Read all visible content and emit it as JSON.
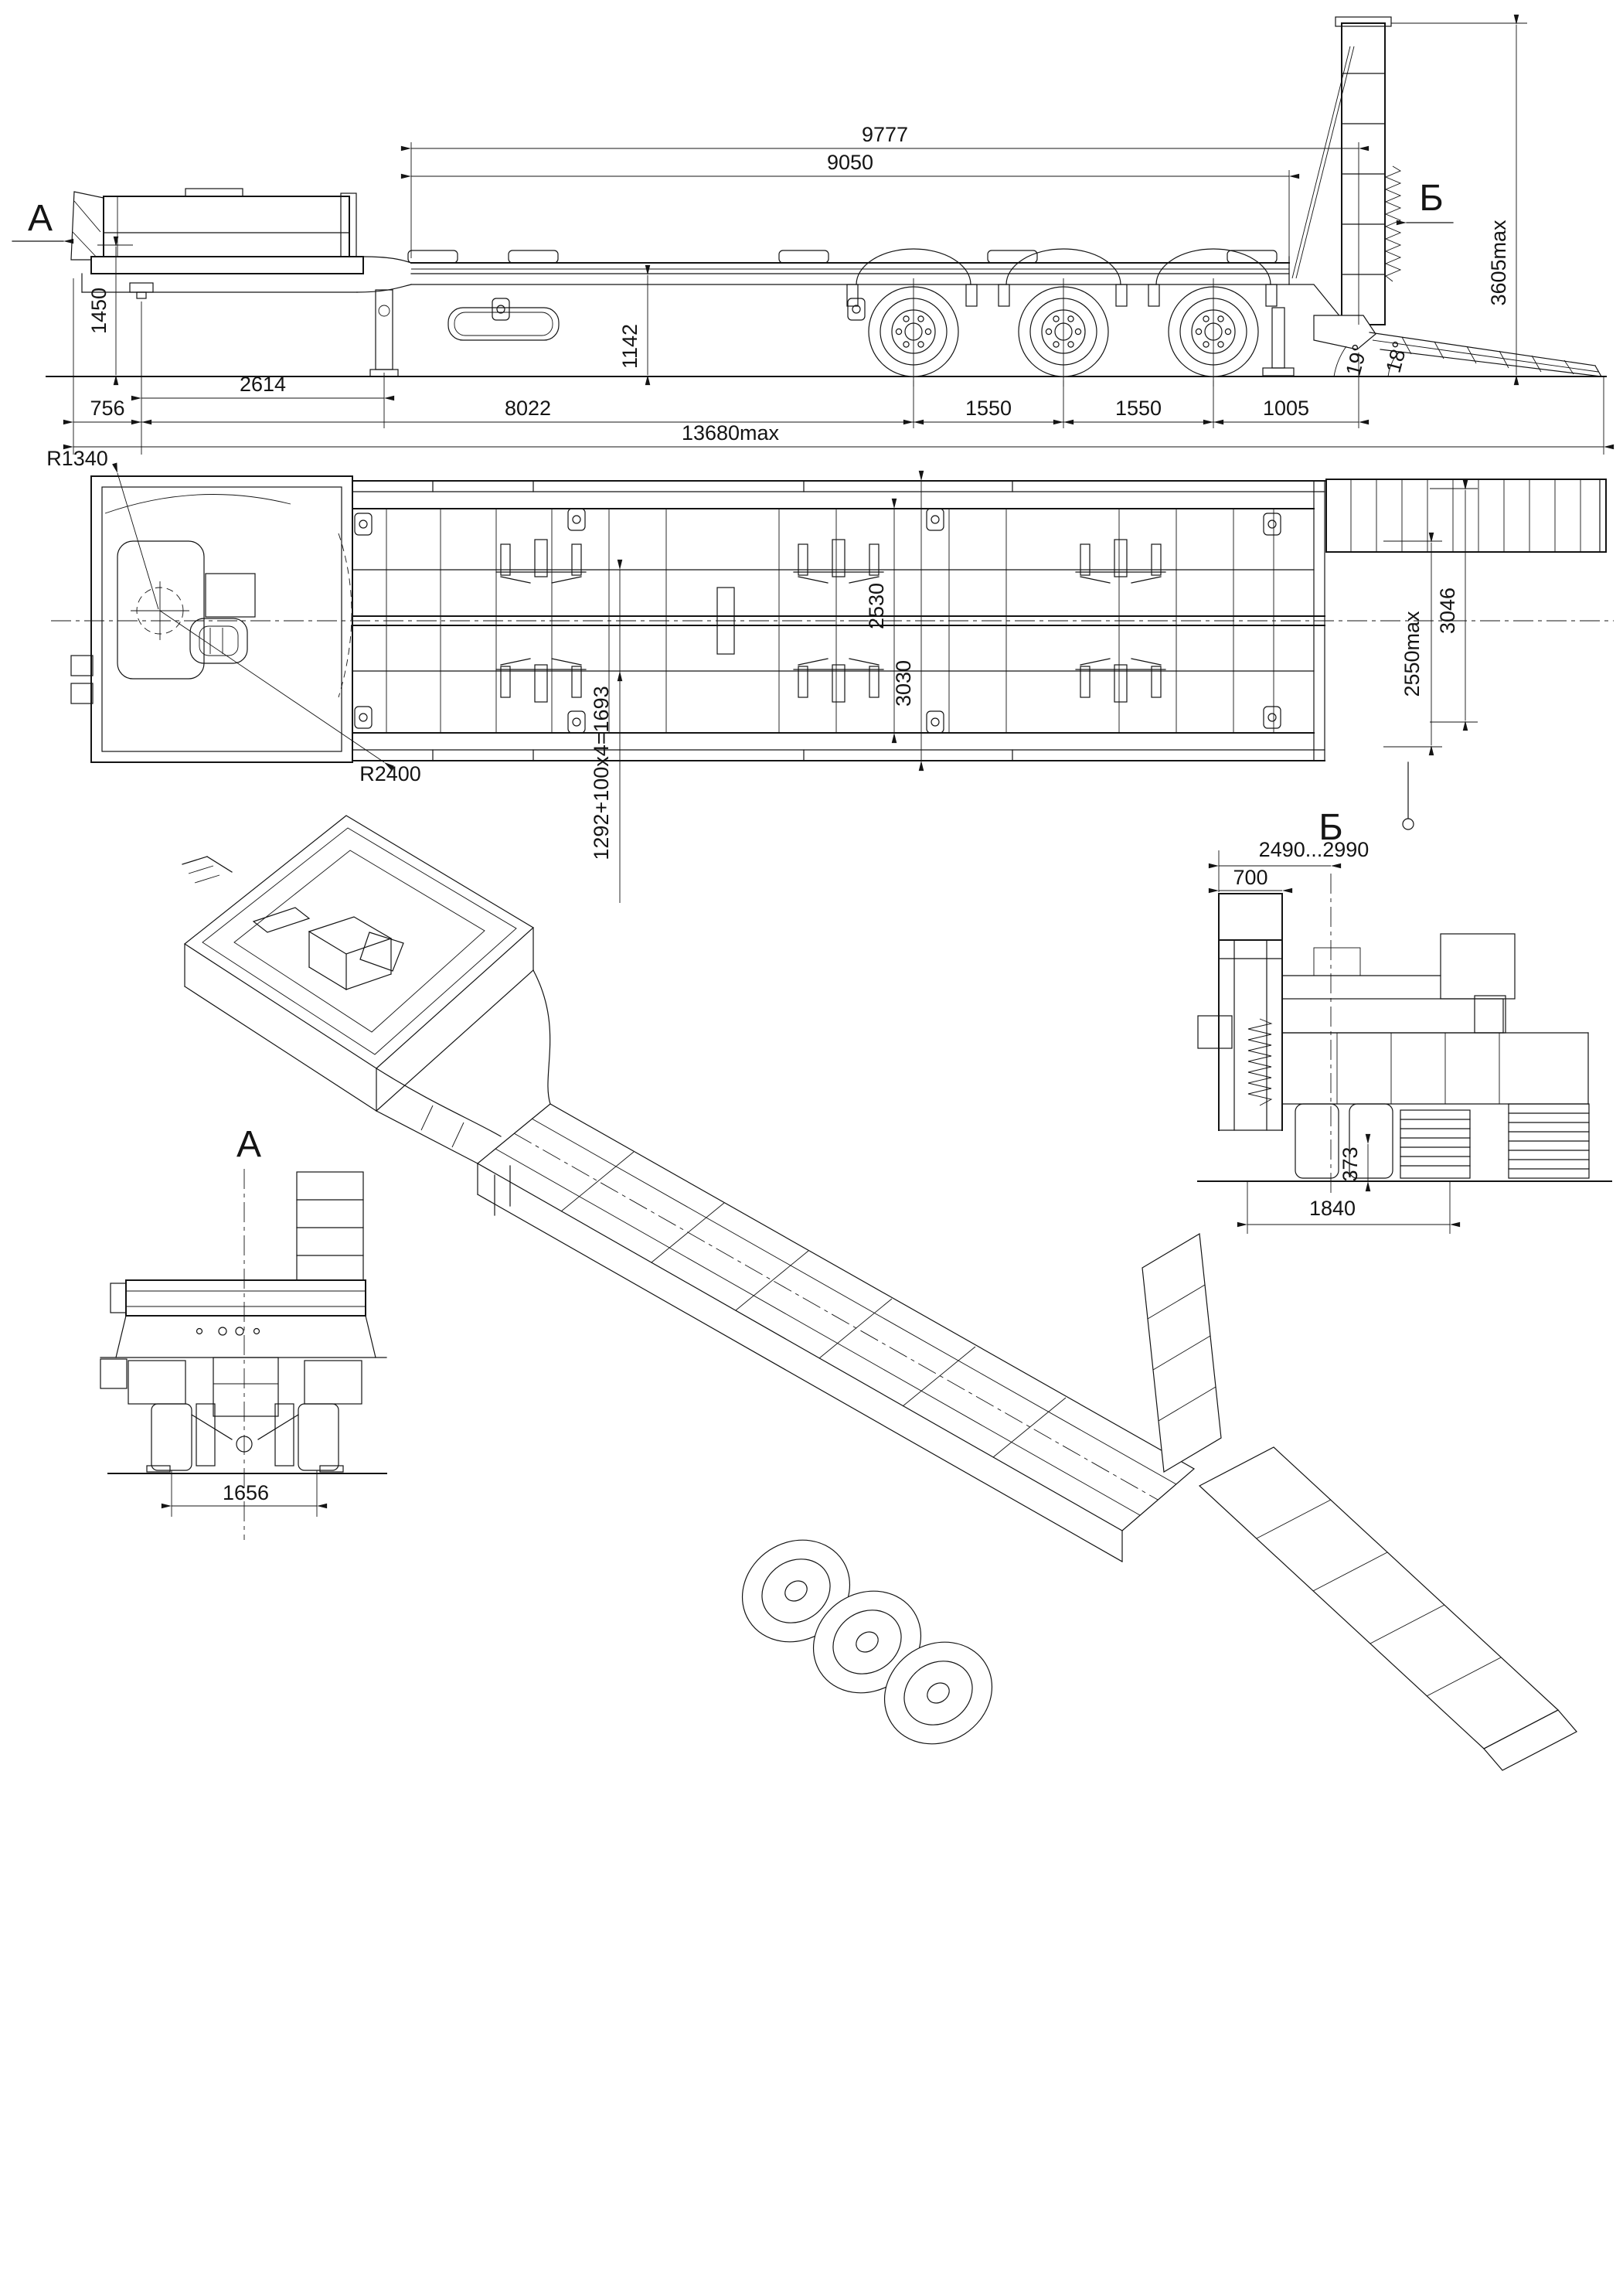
{
  "drawing": {
    "side_view": {
      "section_label_a": "А",
      "section_label_b": "Б",
      "dim_top_overall": "9777",
      "dim_deck_length": "9050",
      "dim_fifth_wheel_height": "1450",
      "dim_deck_height": "1142",
      "dim_ramp_height_max": "3605max",
      "dim_gooseneck_length": "2614",
      "dim_front_overhang": "756",
      "dim_kingpin_to_first_axle": "8022",
      "dim_axle_spacing_1": "1550",
      "dim_axle_spacing_2": "1550",
      "dim_axle_to_ramp_pivot": "1005",
      "dim_total_length_max": "13680max",
      "angle_ramp_pivot": "19°",
      "angle_ramp": "18°"
    },
    "plan_view": {
      "radius_front_swing": "R1340",
      "radius_rear_swing": "R2400",
      "dim_deck_width": "2530",
      "dim_overall_width": "3030",
      "dim_stake_spacing": "1292+100x4=1693",
      "dim_width_max": "2550max",
      "dim_ramp_width": "3046"
    },
    "section_b_view": {
      "title": "Б",
      "dim_height_range": "2490...2990",
      "dim_ramp_column_width": "700",
      "dim_ground_clearance": "373",
      "dim_track": "1840"
    },
    "section_a_view": {
      "title": "А",
      "dim_track": "1656"
    }
  }
}
